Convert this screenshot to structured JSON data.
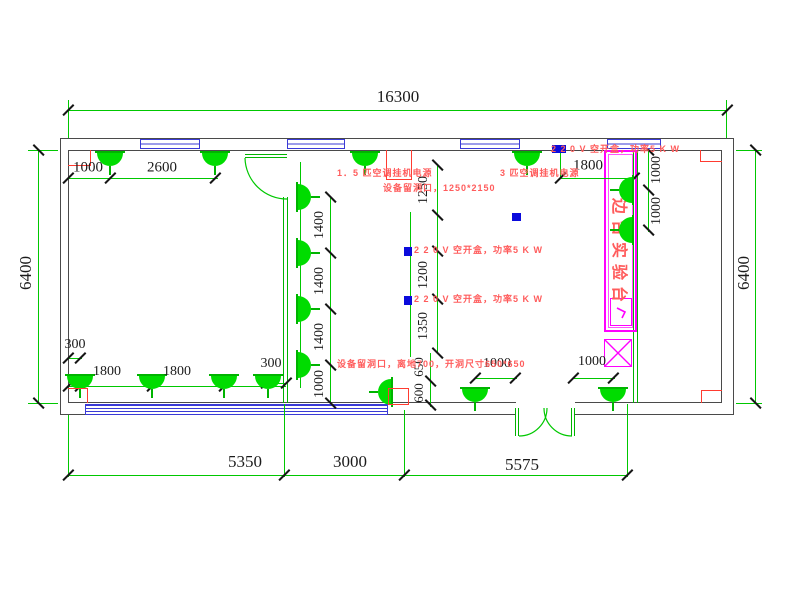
{
  "drawing": {
    "bench_label": "边台实验台",
    "colors": {
      "wall": "#4a4a4a",
      "green": "#00c800",
      "lamp": "#00dc00",
      "socket_blue": "#0b0bdc",
      "window_blue": "#3a3ad6",
      "annotation_red": "#ff5c5c",
      "opening_red": "#ff3b30",
      "bench_magenta": "#ff00ff",
      "dim_text": "#1b1b1b"
    },
    "dim_labels": [
      {
        "t": "16300",
        "x": 398,
        "y": 97,
        "r": 0,
        "s": 17
      },
      {
        "t": "6400",
        "x": 26,
        "y": 273,
        "r": -90,
        "s": 17
      },
      {
        "t": "6400",
        "x": 744,
        "y": 273,
        "r": -90,
        "s": 17
      },
      {
        "t": "5350",
        "x": 245,
        "y": 462,
        "r": 0,
        "s": 17
      },
      {
        "t": "3000",
        "x": 350,
        "y": 462,
        "r": 0,
        "s": 17
      },
      {
        "t": "5575",
        "x": 522,
        "y": 465,
        "r": 0,
        "s": 17
      },
      {
        "t": "1000",
        "x": 88,
        "y": 168,
        "r": 0,
        "s": 15
      },
      {
        "t": "2600",
        "x": 162,
        "y": 168,
        "r": 0,
        "s": 15
      },
      {
        "t": "1800",
        "x": 588,
        "y": 166,
        "r": 0,
        "s": 15
      },
      {
        "t": "1000",
        "x": 657,
        "y": 170,
        "r": -90,
        "s": 14
      },
      {
        "t": "1000",
        "x": 657,
        "y": 211,
        "r": -90,
        "s": 14
      },
      {
        "t": "1400",
        "x": 320,
        "y": 225,
        "r": -90,
        "s": 14
      },
      {
        "t": "1400",
        "x": 320,
        "y": 281,
        "r": -90,
        "s": 14
      },
      {
        "t": "1400",
        "x": 320,
        "y": 337,
        "r": -90,
        "s": 14
      },
      {
        "t": "1000",
        "x": 320,
        "y": 384,
        "r": -90,
        "s": 14
      },
      {
        "t": "1250",
        "x": 424,
        "y": 190,
        "r": -90,
        "s": 14
      },
      {
        "t": "1200",
        "x": 424,
        "y": 275,
        "r": -90,
        "s": 14
      },
      {
        "t": "1350",
        "x": 424,
        "y": 326,
        "r": -90,
        "s": 14
      },
      {
        "t": "650",
        "x": 419,
        "y": 367,
        "r": -90,
        "s": 13
      },
      {
        "t": "600",
        "x": 419,
        "y": 393,
        "r": -90,
        "s": 13
      },
      {
        "t": "300",
        "x": 75,
        "y": 345,
        "r": 0,
        "s": 14
      },
      {
        "t": "1800",
        "x": 107,
        "y": 372,
        "r": 0,
        "s": 14
      },
      {
        "t": "1800",
        "x": 177,
        "y": 372,
        "r": 0,
        "s": 14
      },
      {
        "t": "300",
        "x": 271,
        "y": 364,
        "r": 0,
        "s": 14
      },
      {
        "t": "1000",
        "x": 497,
        "y": 364,
        "r": 0,
        "s": 14
      },
      {
        "t": "1000",
        "x": 592,
        "y": 362,
        "r": 0,
        "s": 14
      }
    ],
    "annotations": [
      {
        "t": "1．5 匹空调挂机电源",
        "x": 337,
        "y": 171
      },
      {
        "t": "3 匹空调挂机电源",
        "x": 500,
        "y": 171
      },
      {
        "t": "设备留洞口，1250*2150",
        "x": 383,
        "y": 186
      },
      {
        "t": "2 2 0 V 空开盒，功率5 K W",
        "x": 551,
        "y": 147
      },
      {
        "t": "2 2 0 V 空开盒，功率5 K W",
        "x": 414,
        "y": 248
      },
      {
        "t": "2 2 0 V 空开盒，功率5 K W",
        "x": 414,
        "y": 297
      },
      {
        "t": "设备留洞口，离地700，开洞尺寸650*650",
        "x": 337,
        "y": 362
      }
    ],
    "lamps": [
      {
        "x": 110,
        "y": 152,
        "d": "down"
      },
      {
        "x": 215,
        "y": 152,
        "d": "down"
      },
      {
        "x": 365,
        "y": 152,
        "d": "down"
      },
      {
        "x": 527,
        "y": 152,
        "d": "down"
      },
      {
        "x": 297,
        "y": 197,
        "d": "right"
      },
      {
        "x": 297,
        "y": 253,
        "d": "right"
      },
      {
        "x": 297,
        "y": 309,
        "d": "right"
      },
      {
        "x": 297,
        "y": 365,
        "d": "right"
      },
      {
        "x": 633,
        "y": 190,
        "d": "left"
      },
      {
        "x": 633,
        "y": 230,
        "d": "left"
      },
      {
        "x": 80,
        "y": 375,
        "d": "down"
      },
      {
        "x": 152,
        "y": 375,
        "d": "down"
      },
      {
        "x": 224,
        "y": 375,
        "d": "down"
      },
      {
        "x": 268,
        "y": 375,
        "d": "down"
      },
      {
        "x": 475,
        "y": 388,
        "d": "down"
      },
      {
        "x": 613,
        "y": 388,
        "d": "down"
      },
      {
        "x": 392,
        "y": 392,
        "d": "left"
      }
    ],
    "sockets": [
      {
        "x": 552,
        "y": 145,
        "w": 14,
        "h": 8
      },
      {
        "x": 512,
        "y": 213,
        "w": 9,
        "h": 8
      },
      {
        "x": 404,
        "y": 247,
        "w": 8,
        "h": 9
      },
      {
        "x": 404,
        "y": 296,
        "w": 8,
        "h": 9
      }
    ],
    "windows": [
      {
        "x": 140,
        "w": 60
      },
      {
        "x": 287,
        "w": 58
      },
      {
        "x": 460,
        "w": 60
      },
      {
        "x": 607,
        "w": 54
      }
    ],
    "lines": [
      {
        "x": 68,
        "y": 110,
        "w": 659,
        "h": 1
      },
      {
        "x": 68,
        "y": 100,
        "w": 1,
        "h": 38
      },
      {
        "x": 726,
        "y": 100,
        "w": 1,
        "h": 38
      },
      {
        "x": 68,
        "y": 475,
        "w": 560,
        "h": 1
      },
      {
        "x": 68,
        "y": 415,
        "w": 1,
        "h": 62
      },
      {
        "x": 284,
        "y": 404,
        "w": 1,
        "h": 73
      },
      {
        "x": 404,
        "y": 410,
        "w": 1,
        "h": 67
      },
      {
        "x": 627,
        "y": 404,
        "w": 1,
        "h": 73
      },
      {
        "x": 38,
        "y": 150,
        "w": 1,
        "h": 253
      },
      {
        "x": 28,
        "y": 150,
        "w": 30,
        "h": 1
      },
      {
        "x": 28,
        "y": 403,
        "w": 30,
        "h": 1
      },
      {
        "x": 755,
        "y": 150,
        "w": 1,
        "h": 253
      },
      {
        "x": 736,
        "y": 150,
        "w": 26,
        "h": 1
      },
      {
        "x": 736,
        "y": 403,
        "w": 26,
        "h": 1
      },
      {
        "x": 68,
        "y": 178,
        "w": 150,
        "h": 1
      },
      {
        "x": 560,
        "y": 178,
        "w": 76,
        "h": 1
      },
      {
        "x": 560,
        "y": 152,
        "w": 1,
        "h": 26
      },
      {
        "x": 330,
        "y": 197,
        "w": 1,
        "h": 206
      },
      {
        "x": 437,
        "y": 165,
        "w": 1,
        "h": 188
      },
      {
        "x": 430,
        "y": 353,
        "w": 1,
        "h": 54
      },
      {
        "x": 648,
        "y": 150,
        "w": 1,
        "h": 82
      },
      {
        "x": 68,
        "y": 386,
        "w": 218,
        "h": 1
      },
      {
        "x": 68,
        "y": 358,
        "w": 14,
        "h": 1
      },
      {
        "x": 264,
        "y": 383,
        "w": 23,
        "h": 1
      },
      {
        "x": 475,
        "y": 378,
        "w": 42,
        "h": 1
      },
      {
        "x": 573,
        "y": 378,
        "w": 42,
        "h": 1
      },
      {
        "x": 410,
        "y": 212,
        "w": 1,
        "h": 145
      },
      {
        "x": 300,
        "y": 162,
        "w": 1,
        "h": 226
      }
    ],
    "ticks": [
      {
        "x": 68,
        "y": 110,
        "o": "h"
      },
      {
        "x": 727,
        "y": 110,
        "o": "h"
      },
      {
        "x": 68,
        "y": 475,
        "o": "h"
      },
      {
        "x": 284,
        "y": 475,
        "o": "h"
      },
      {
        "x": 404,
        "y": 475,
        "o": "h"
      },
      {
        "x": 627,
        "y": 475,
        "o": "h"
      },
      {
        "x": 38,
        "y": 150,
        "o": "v"
      },
      {
        "x": 38,
        "y": 403,
        "o": "v"
      },
      {
        "x": 755,
        "y": 150,
        "o": "v"
      },
      {
        "x": 755,
        "y": 403,
        "o": "v"
      },
      {
        "x": 68,
        "y": 178,
        "o": "h"
      },
      {
        "x": 110,
        "y": 178,
        "o": "h"
      },
      {
        "x": 215,
        "y": 178,
        "o": "h"
      },
      {
        "x": 560,
        "y": 178,
        "o": "h"
      },
      {
        "x": 634,
        "y": 178,
        "o": "h"
      },
      {
        "x": 330,
        "y": 197,
        "o": "v"
      },
      {
        "x": 330,
        "y": 253,
        "o": "v"
      },
      {
        "x": 330,
        "y": 309,
        "o": "v"
      },
      {
        "x": 330,
        "y": 365,
        "o": "v"
      },
      {
        "x": 330,
        "y": 403,
        "o": "v"
      },
      {
        "x": 437,
        "y": 165,
        "o": "v"
      },
      {
        "x": 437,
        "y": 215,
        "o": "v"
      },
      {
        "x": 437,
        "y": 251,
        "o": "v"
      },
      {
        "x": 437,
        "y": 299,
        "o": "v"
      },
      {
        "x": 437,
        "y": 353,
        "o": "v"
      },
      {
        "x": 430,
        "y": 381,
        "o": "v"
      },
      {
        "x": 430,
        "y": 405,
        "o": "v"
      },
      {
        "x": 648,
        "y": 150,
        "o": "v"
      },
      {
        "x": 648,
        "y": 190,
        "o": "v"
      },
      {
        "x": 648,
        "y": 230,
        "o": "v"
      },
      {
        "x": 68,
        "y": 386,
        "o": "h"
      },
      {
        "x": 80,
        "y": 386,
        "o": "h"
      },
      {
        "x": 152,
        "y": 386,
        "o": "h"
      },
      {
        "x": 224,
        "y": 386,
        "o": "h"
      },
      {
        "x": 68,
        "y": 358,
        "o": "h"
      },
      {
        "x": 80,
        "y": 358,
        "o": "h"
      },
      {
        "x": 266,
        "y": 383,
        "o": "h"
      },
      {
        "x": 286,
        "y": 383,
        "o": "h"
      },
      {
        "x": 475,
        "y": 378,
        "o": "h"
      },
      {
        "x": 515,
        "y": 378,
        "o": "h"
      },
      {
        "x": 573,
        "y": 378,
        "o": "h"
      },
      {
        "x": 613,
        "y": 378,
        "o": "h"
      }
    ],
    "red_boxes": [
      {
        "x": 386,
        "y": 150,
        "w": 26,
        "h": 30,
        "sides": "lrb",
        "name": "equipment-opening-top"
      },
      {
        "x": 388,
        "y": 388,
        "w": 21,
        "h": 17,
        "sides": "lrtb",
        "name": "equipment-opening-bottom"
      },
      {
        "x": 68,
        "y": 150,
        "w": 23,
        "h": 16,
        "sides": "rb",
        "name": "corner-mark-top-left"
      },
      {
        "x": 700,
        "y": 150,
        "w": 22,
        "h": 12,
        "sides": "lb",
        "name": "corner-mark-top-right"
      },
      {
        "x": 68,
        "y": 388,
        "w": 20,
        "h": 15,
        "sides": "rt",
        "name": "corner-mark-bottom-left"
      },
      {
        "x": 701,
        "y": 390,
        "w": 21,
        "h": 13,
        "sides": "lt",
        "name": "corner-mark-bottom-right"
      }
    ]
  }
}
